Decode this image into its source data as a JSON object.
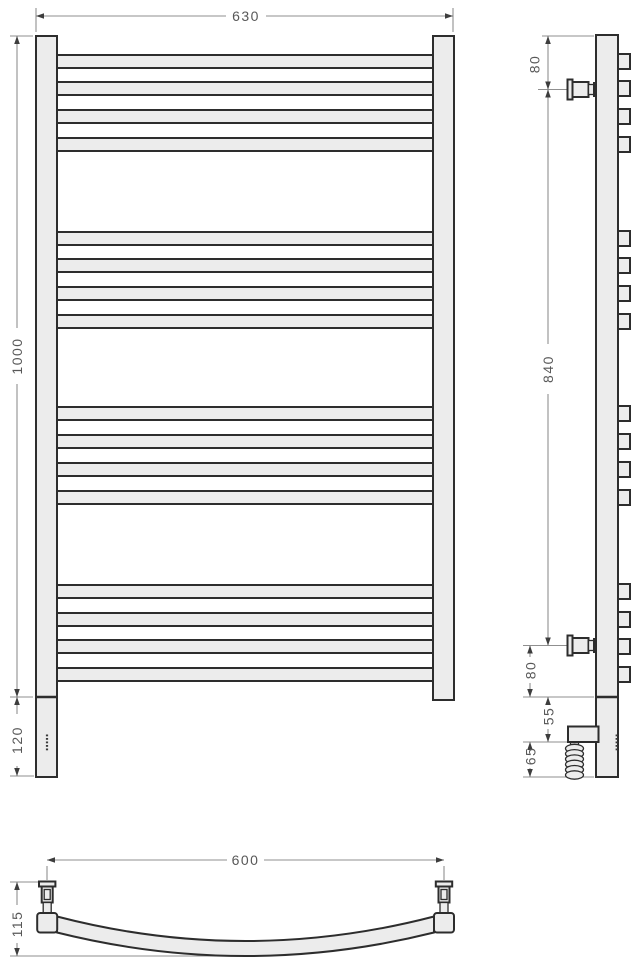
{
  "drawing": {
    "title": "heated towel rail dimensional drawing",
    "colors": {
      "background": "#ffffff",
      "part_fill": "#ececec",
      "part_stroke": "#2d2d2d",
      "dim_lines": "#8f8f8f",
      "dim_text": "#585858"
    },
    "dims": {
      "front_width": "630",
      "front_height": "1000",
      "front_bottom_ext": "120",
      "side_top_offset": "80",
      "side_bracket_span": "840",
      "side_bottom_offset": "80",
      "side_element_offset": "55",
      "side_element_to_end": "65",
      "bottom_axle_width": "600",
      "bottom_depth": "115"
    },
    "geometry": {
      "rung_tops": [
        55,
        82,
        110,
        138,
        232,
        259,
        287,
        315,
        407,
        435,
        463,
        491,
        585,
        613,
        640,
        668
      ],
      "rung_height": 13,
      "front": {
        "rung_x": 57,
        "rung_width": 376
      },
      "side": {
        "stub_x": 618,
        "stub_width": 12,
        "stub_height": 15,
        "bracket_centers": [
          89.5,
          645.5
        ],
        "coil": {
          "cx": 574.5,
          "rx": 9,
          "ry": 4.2,
          "start_y": 748.5,
          "step": 5.3,
          "count": 6
        }
      },
      "dots": {
        "front_x": 45.9,
        "side_x": 615.6,
        "start_y": 734.5,
        "step": 3.5,
        "count": 5,
        "w": 2.2,
        "h": 1.8
      },
      "bottom": {
        "valve_centers": [
          47.2,
          444
        ]
      }
    }
  }
}
